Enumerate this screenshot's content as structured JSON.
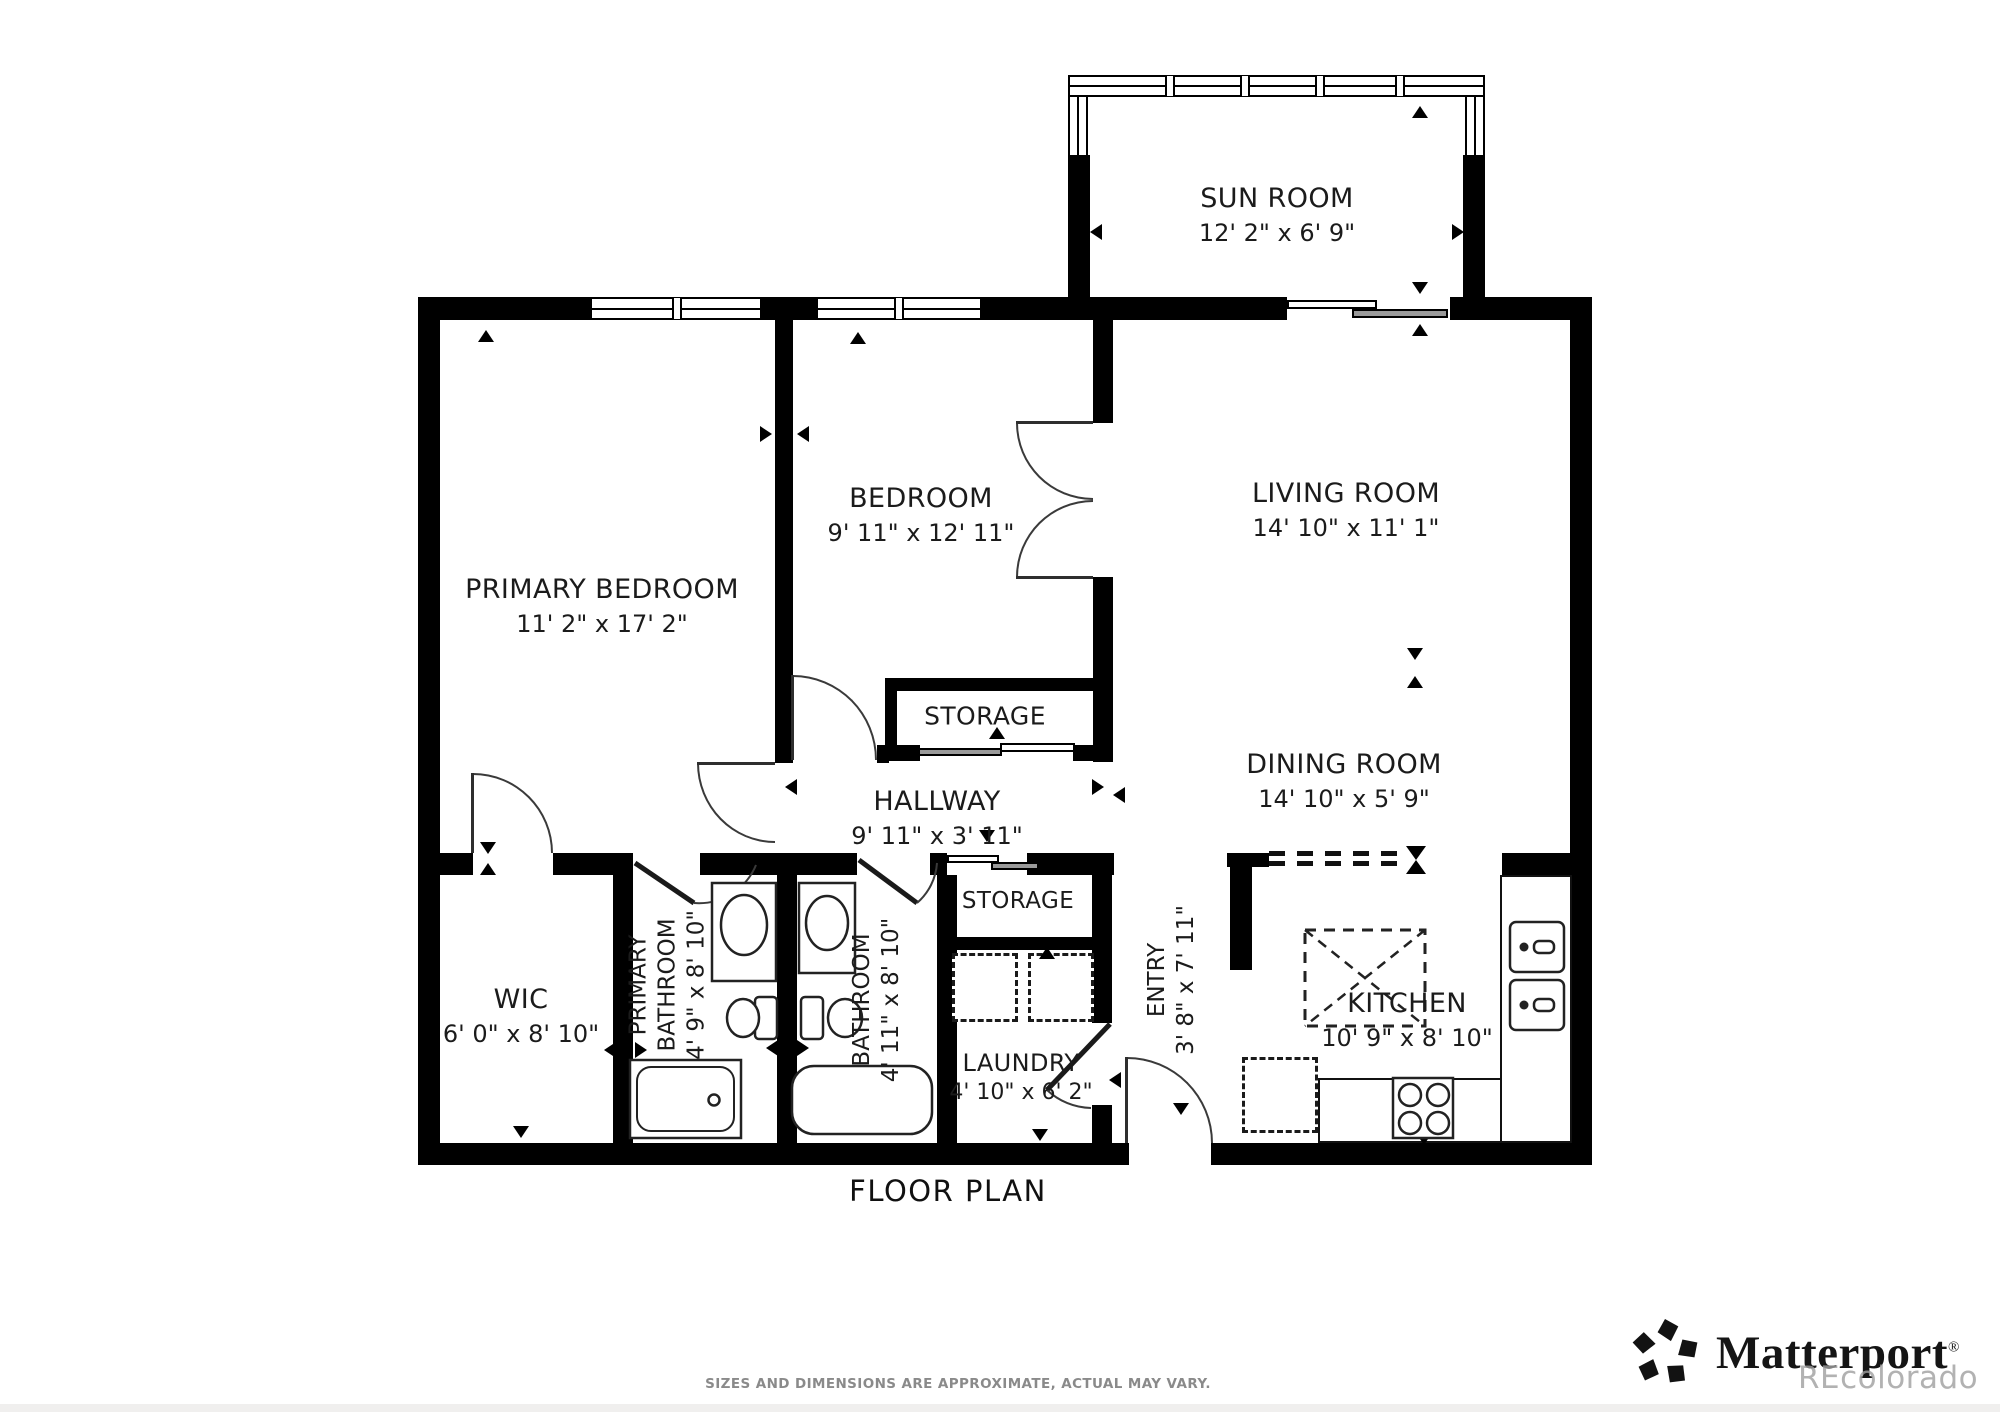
{
  "title": "FLOOR PLAN",
  "disclaimer": "SIZES AND DIMENSIONS ARE APPROXIMATE, ACTUAL MAY VARY.",
  "branding": {
    "logo_text": "Matterport",
    "registered_mark": "®",
    "watermark": "REcolorado"
  },
  "rooms": {
    "sun_room": {
      "name": "SUN ROOM",
      "dims": "12' 2\" x 6' 9\""
    },
    "primary_bedroom": {
      "name": "PRIMARY BEDROOM",
      "dims": "11' 2\" x 17' 2\""
    },
    "bedroom": {
      "name": "BEDROOM",
      "dims": "9' 11\" x 12' 11\""
    },
    "living_room": {
      "name": "LIVING ROOM",
      "dims": "14' 10\" x 11' 1\""
    },
    "dining_room": {
      "name": "DINING ROOM",
      "dims": "14' 10\" x 5' 9\""
    },
    "hallway": {
      "name": "HALLWAY",
      "dims": "9' 11\" x 3' 11\""
    },
    "storage_upper": {
      "name": "STORAGE"
    },
    "storage_lower": {
      "name": "STORAGE"
    },
    "wic": {
      "name": "WIC",
      "dims": "6' 0\" x 8' 10\""
    },
    "primary_bathroom": {
      "name_line1": "PRIMARY",
      "name_line2": "BATHROOM",
      "dims": "4' 9\" x 8' 10\""
    },
    "bathroom": {
      "name": "BATHROOM",
      "dims": "4' 11\" x 8' 10\""
    },
    "laundry": {
      "name": "LAUNDRY",
      "dims": "4' 10\" x 6' 2\""
    },
    "entry": {
      "name": "ENTRY",
      "dims": "3' 8\" x 7' 11\""
    },
    "kitchen": {
      "name": "KITCHEN",
      "dims": "10' 9\" x 8' 10\""
    }
  },
  "icons": {
    "matterport-logo-icon": "five-petal pinwheel pentagon",
    "toilet-icon": "tank + bowl outline",
    "sink-icon": "vanity rectangle with oval basin",
    "bathtub-icon": "rounded rectangle tub",
    "shower-icon": "square pan with drain",
    "stove-icon": "four burner circles",
    "kitchen-sink-icon": "double basin with faucets",
    "washer-icon": "dashed square",
    "dryer-icon": "dashed square",
    "dishwasher-icon": "dashed square",
    "kitchen-island-icon": "dashed rectangle with X",
    "dimension-arrow-icon": "small black triangle",
    "window-icon": "double-line pane",
    "sliding-door-icon": "offset overlapping panels",
    "door-arc-icon": "quarter-circle swing"
  },
  "colors": {
    "wall": "#000000",
    "door_line": "#3a3a3a",
    "text": "#1b1b1b",
    "muted_text": "#8a8a8a",
    "watermark": "#9f9f9f",
    "slider_fill": "#9a9a9a"
  }
}
